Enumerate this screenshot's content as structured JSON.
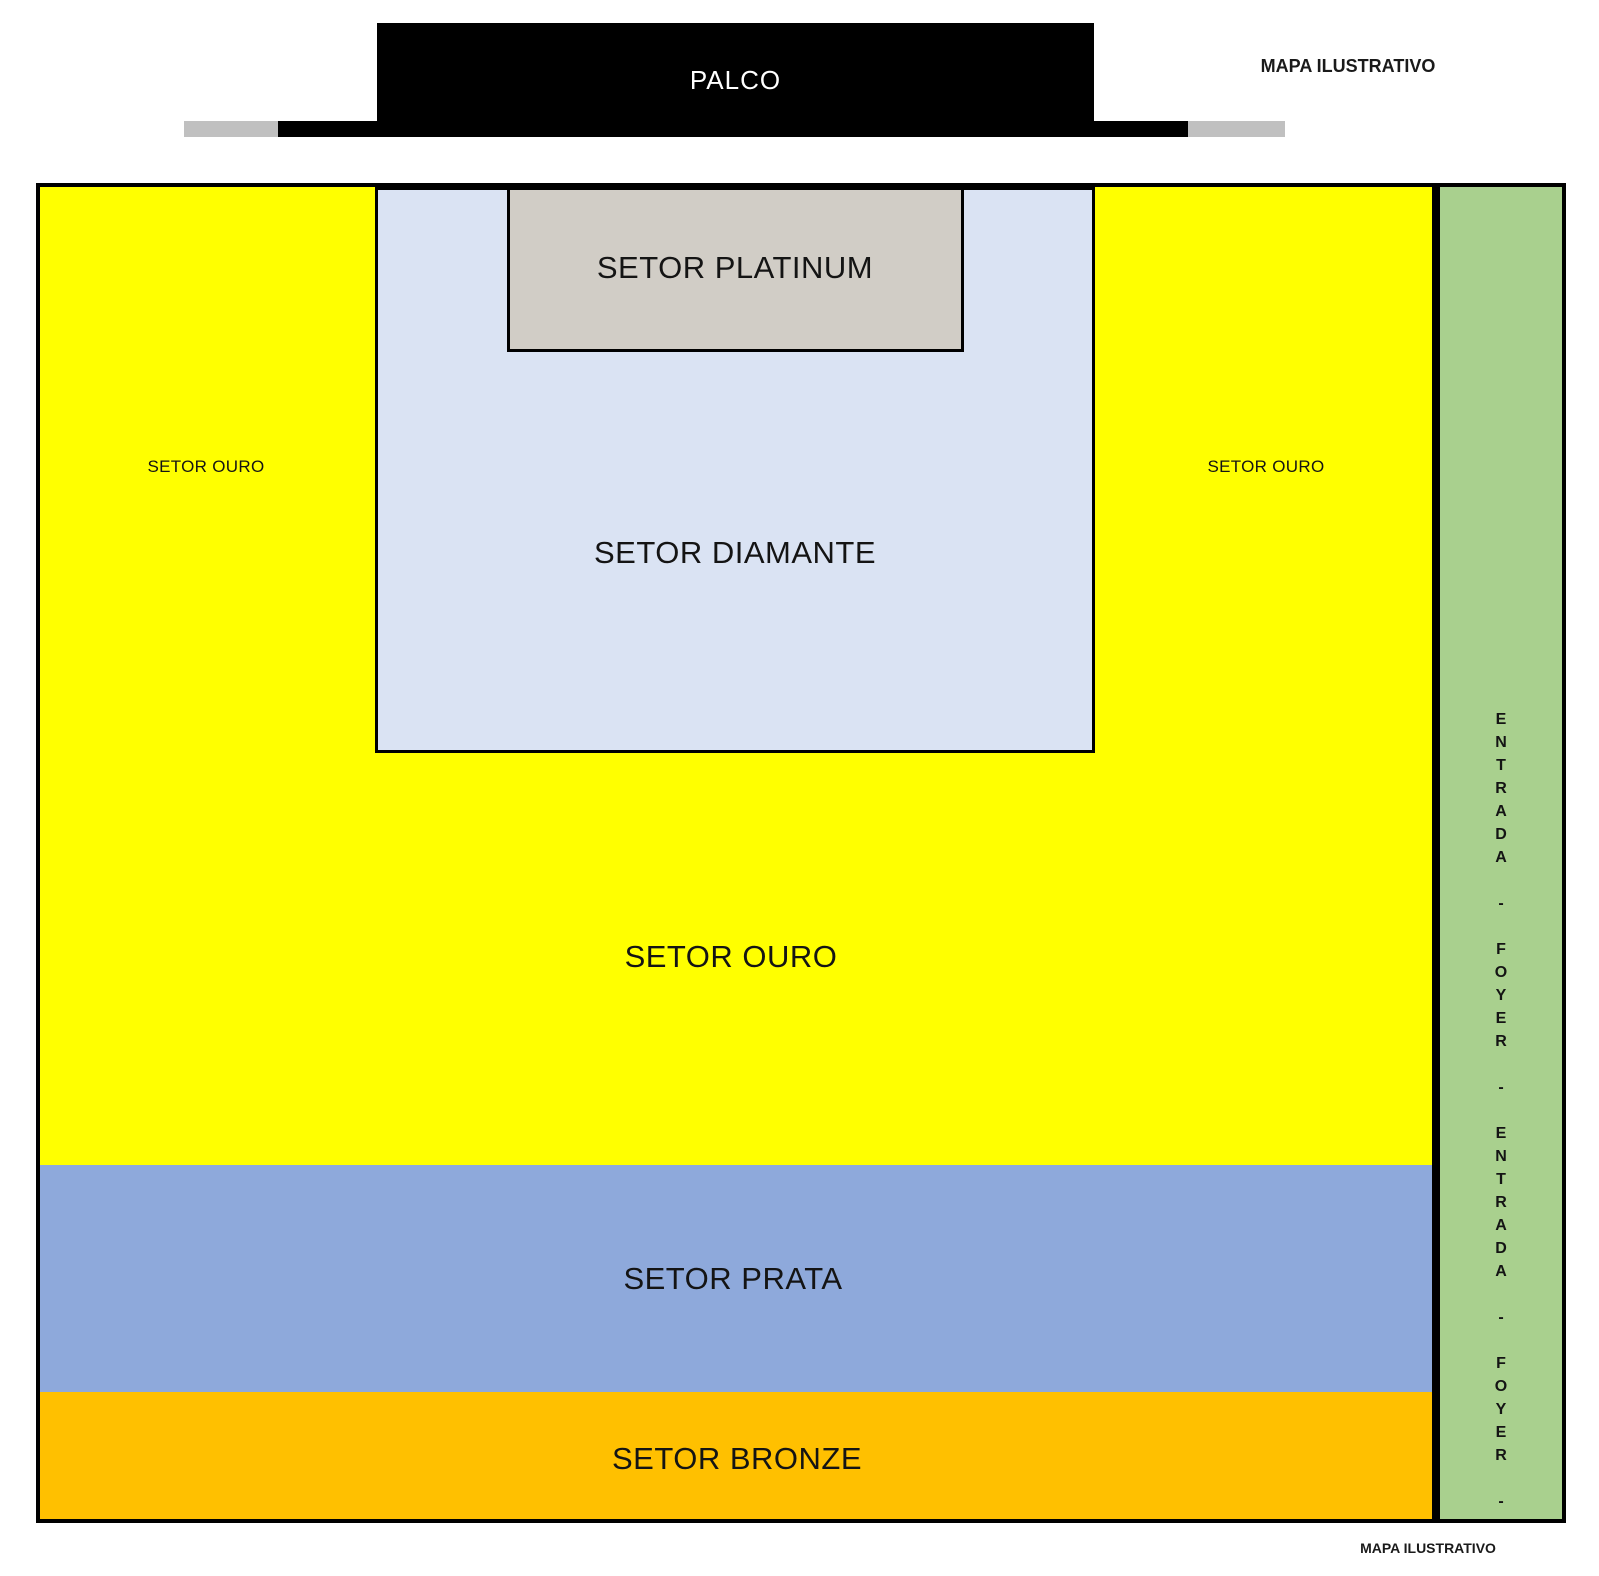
{
  "watermark": {
    "top": "MAPA ILUSTRATIVO",
    "bottom": "MAPA ILUSTRATIVO"
  },
  "stage": {
    "label": "PALCO",
    "color": "#000000",
    "wing_color": "#c0c0c0"
  },
  "sectors": {
    "platinum": {
      "label": "SETOR PLATINUM",
      "color": "#d1cdc6"
    },
    "diamante": {
      "label": "SETOR DIAMANTE",
      "color": "#dae3f3"
    },
    "ouro": {
      "label": "SETOR OURO",
      "color": "#ffff00"
    },
    "prata": {
      "label": "SETOR PRATA",
      "color": "#8ea9db"
    },
    "bronze": {
      "label": "SETOR BRONZE",
      "color": "#ffc000"
    }
  },
  "entrance_strip": {
    "color": "#a9d08e",
    "vertical_text": "E\nN\nT\nR\nA\nD\nA\n\n-\n\nF\nO\nY\nE\nR\n\n-\n\nE\nN\nT\nR\nA\nD\nA\n\n-\n\nF\nO\nY\nE\nR\n\n-"
  }
}
